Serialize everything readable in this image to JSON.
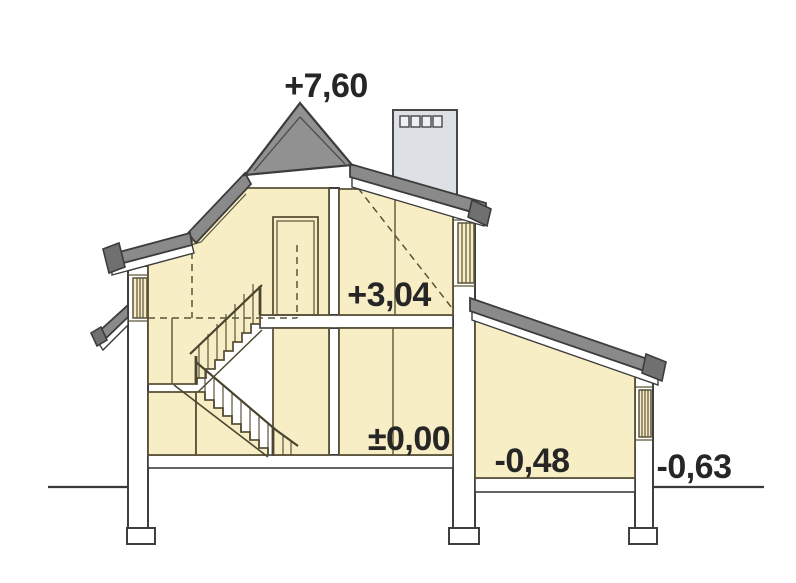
{
  "diagram": {
    "type": "house-cross-section",
    "labels": {
      "ridge_height": "+7,60",
      "upper_floor_level": "+3,04",
      "ground_floor_level": "±0,00",
      "annex_floor_level": "-0,48",
      "terrain_level": "-0,63"
    },
    "colors": {
      "room_fill": "#f8eec5",
      "room_stroke": "#5a5339",
      "roof_fill": "#8a8a8a",
      "roof_cap": "#707070",
      "roof_triangle": "#919191",
      "roof_stroke": "#3c3c3c",
      "chimney_fill": "#dde1e6",
      "wall_fill": "#ffffff",
      "wall_stroke": "#3f3f3f",
      "label_color": "#262626",
      "background": "#ffffff"
    }
  }
}
